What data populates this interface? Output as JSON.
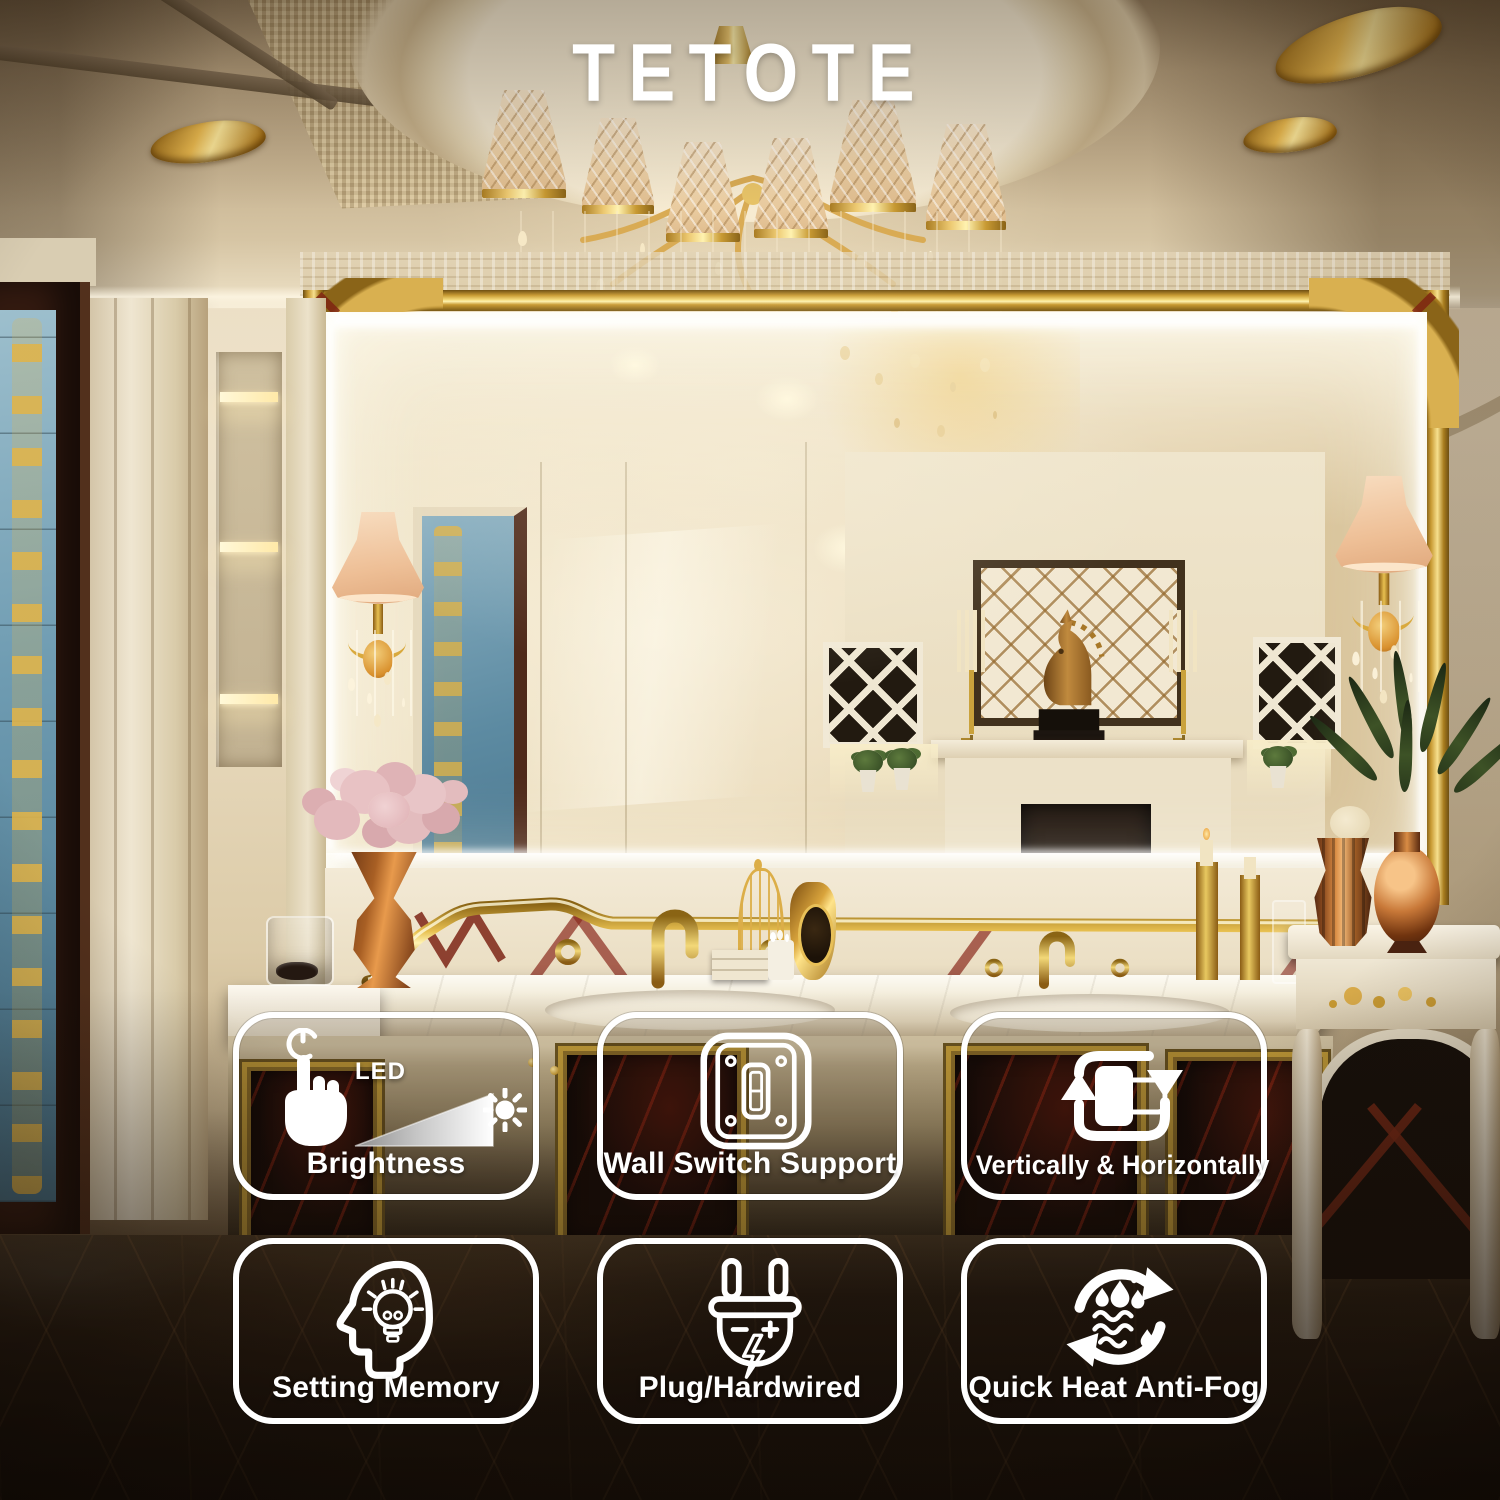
{
  "brand": {
    "logo_text": "TETOTE"
  },
  "features": {
    "items": [
      {
        "label": "Brightness",
        "icon": "touch-dimmer-icon",
        "annotation": "LED"
      },
      {
        "label": "Wall Switch Support",
        "icon": "wall-switch-icon"
      },
      {
        "label": "Vertically & Horizontally",
        "icon": "rotate-orientation-icon"
      },
      {
        "label": "Setting Memory",
        "icon": "memory-head-icon"
      },
      {
        "label": "Plug/Hardwired",
        "icon": "power-plug-icon"
      },
      {
        "label": "Quick Heat Anti-Fog",
        "icon": "anti-fog-icon"
      }
    ]
  },
  "style": {
    "badge_border_color": "#ffffff",
    "badge_text_color": "#ffffff",
    "logo_color": "#ffffff",
    "gold_accent": "#cfa64a",
    "scene_warm_tone": "#e6d5b5",
    "floor_dark": "#241a10"
  }
}
